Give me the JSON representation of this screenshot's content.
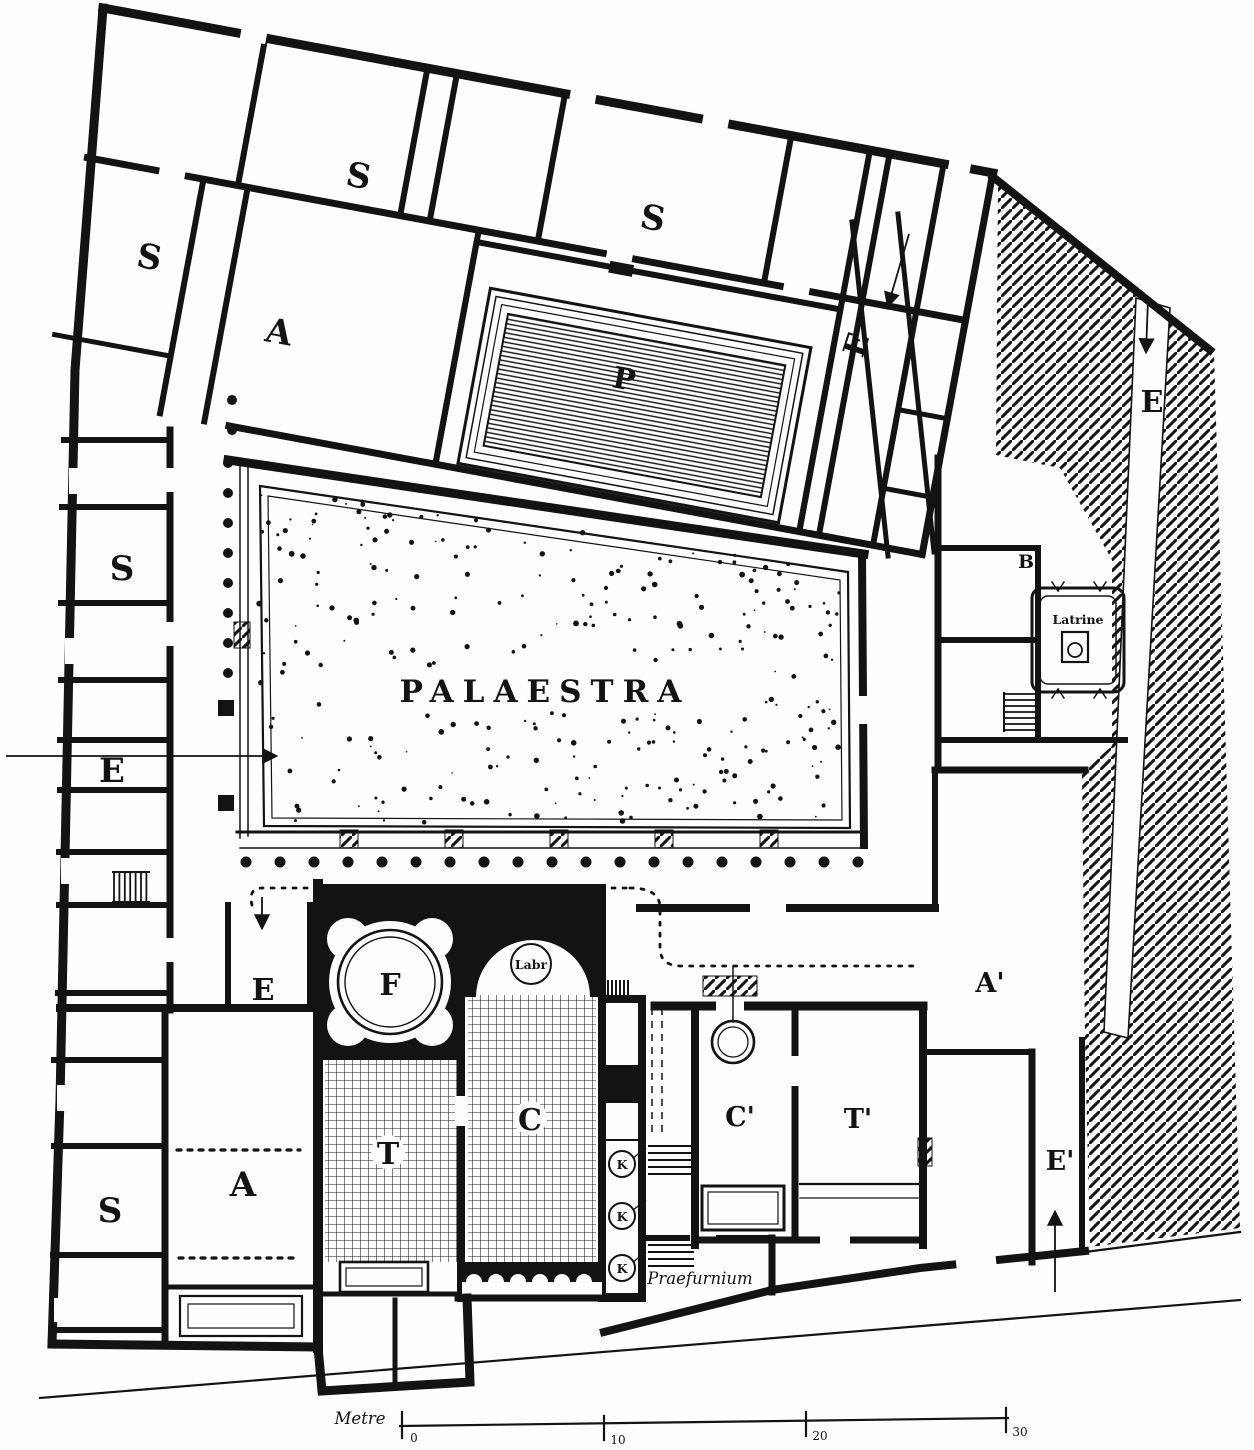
{
  "labels": {
    "palaestra": "PALAESTRA",
    "pool": "P",
    "frigidarium": "F",
    "labrum": "Labr",
    "tepidarium": "T",
    "caldarium": "C",
    "womens_tepidarium": "T'",
    "womens_caldarium": "C'",
    "shop": "S",
    "atrium": "A",
    "court": "A'",
    "entrance": "E",
    "entrance_prime": "E'",
    "boiler": "K",
    "room_b": "B",
    "latrine": "Latrine",
    "praefurnium": "Praefurnium"
  },
  "scale_bar": {
    "unit": "Metre",
    "ticks": [
      "0",
      "10",
      "20",
      "30"
    ]
  }
}
